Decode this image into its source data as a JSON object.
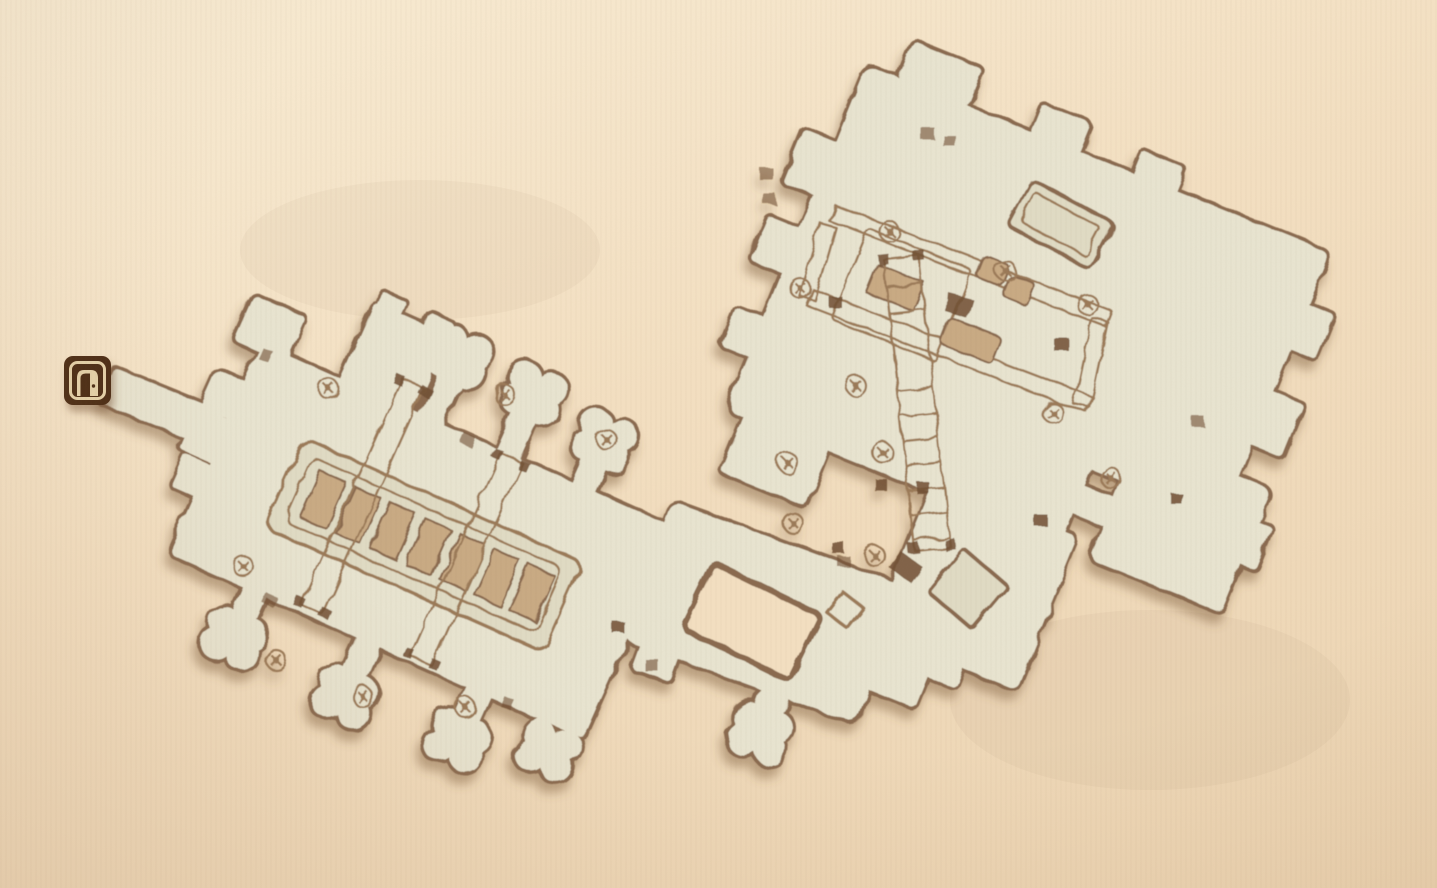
{
  "map": {
    "type": "dungeon-local-map",
    "marker": {
      "icon": "door-icon",
      "transform": "translate(64,356)"
    },
    "colors": {
      "bg": "#f3dfc1",
      "bg-light": "#f8ecd4",
      "bg-dark": "#ecd4b2",
      "floor": "#e8e4d0",
      "floor-dim": "#e0dbc4",
      "wall": "#8a6a4f",
      "wall-dark": "#6f4e33",
      "ink": "#9b7a59",
      "ink-light": "#ab8d6b",
      "slab": "#c9aa84",
      "shadow": "#7d5a3a",
      "door-dark": "#4e2d16",
      "door-light": "#e6d3aa"
    }
  }
}
